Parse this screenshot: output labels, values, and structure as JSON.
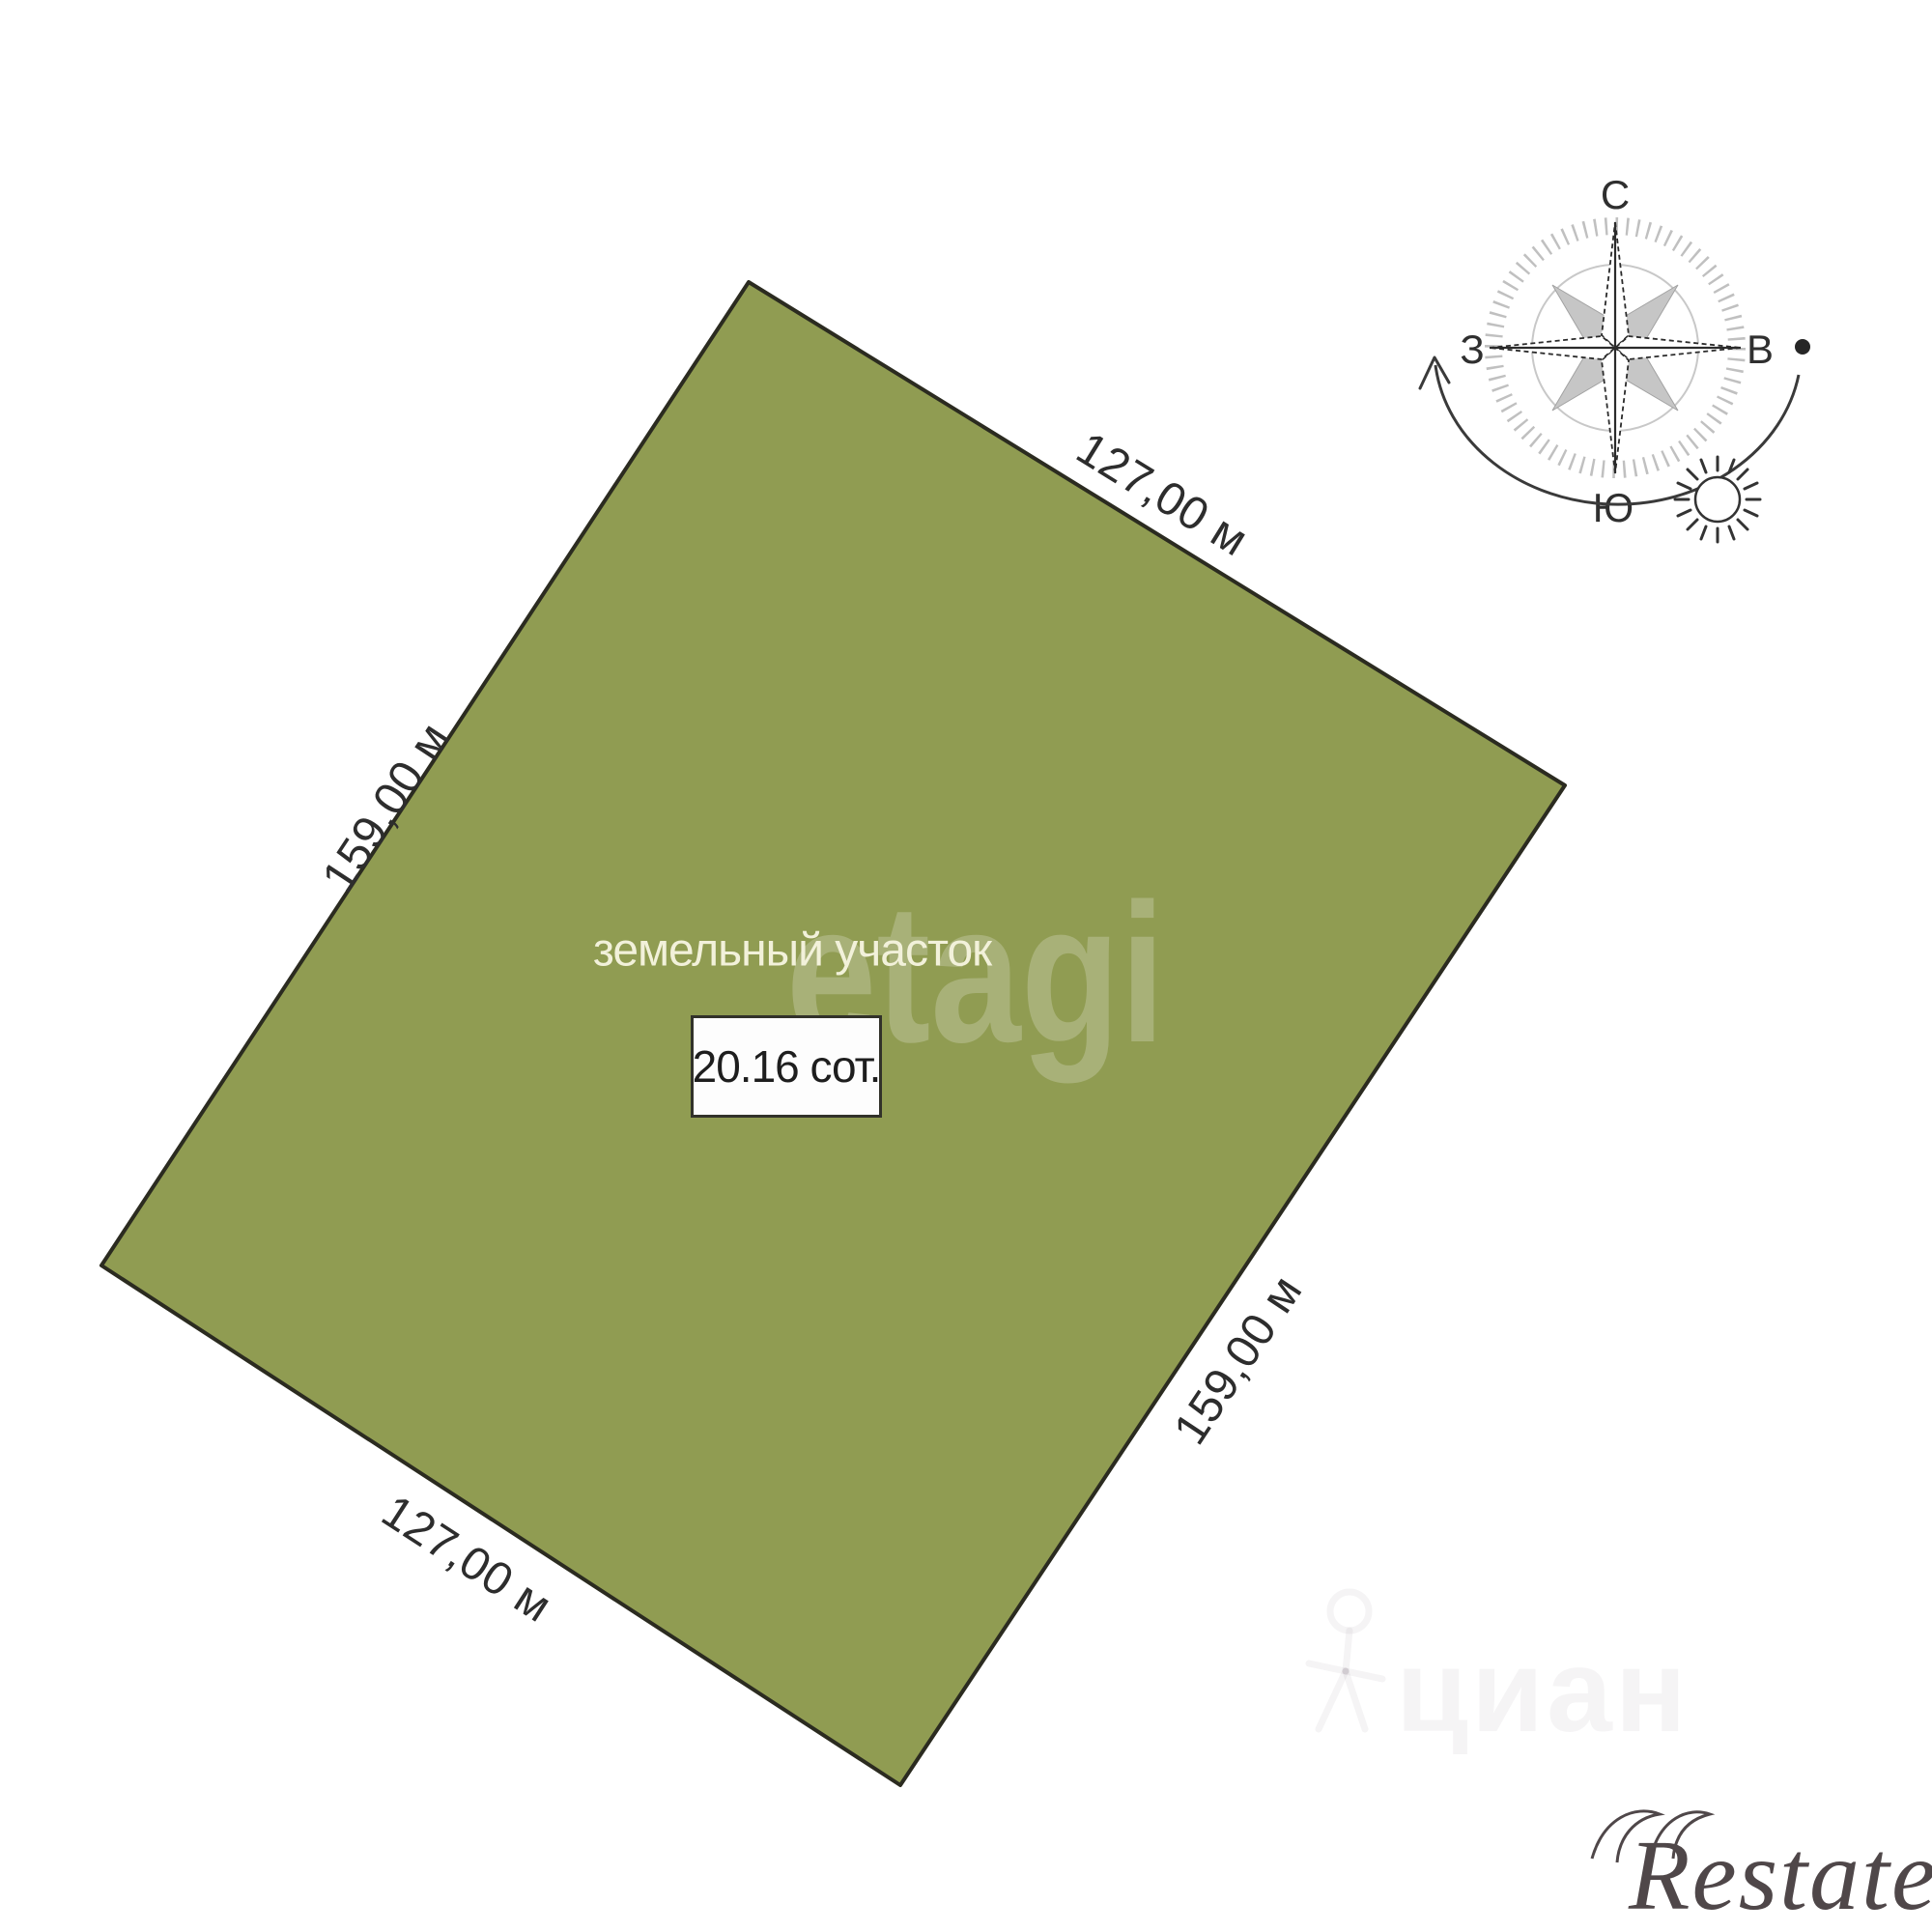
{
  "plot": {
    "type_label": "земельный участок",
    "area_label": "20.16 сот.",
    "fill_color": "#909c52",
    "border_color": "#2b2b20",
    "dimensions": {
      "top": "127,00 м",
      "left": "159,00 м",
      "right": "159,00 м",
      "bottom": "127,00 м"
    }
  },
  "compass": {
    "north": "С",
    "south": "Ю",
    "west": "З",
    "east": "В"
  },
  "watermarks": {
    "etagi": "etagi",
    "cian": "циан",
    "restate": "Restate"
  }
}
